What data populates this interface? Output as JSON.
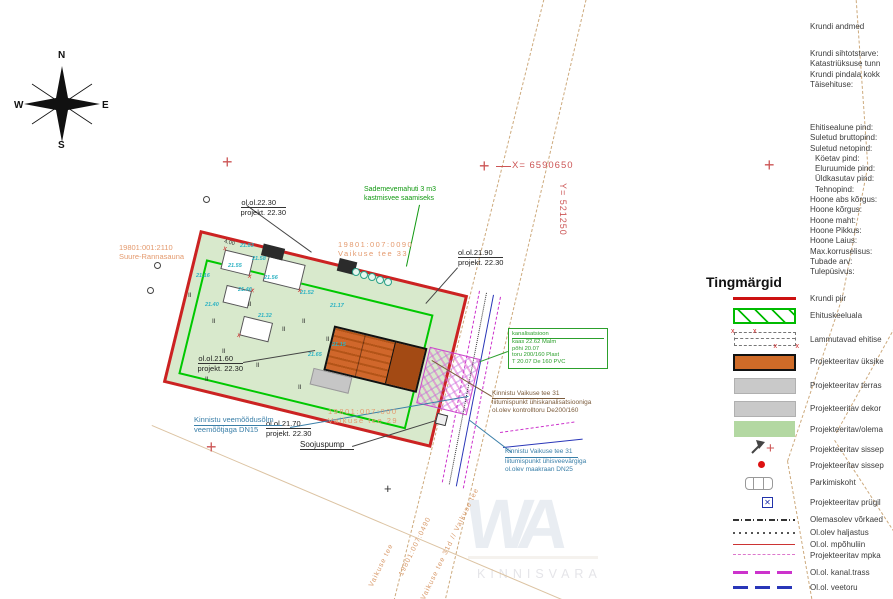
{
  "compass": {
    "n": "N",
    "e": "E",
    "s": "S",
    "w": "W"
  },
  "coords": {
    "x": "X= 6590650",
    "y": "Y= 521250"
  },
  "site_info": {
    "title": "Krundi andmed",
    "rows1": [
      "Krundi sihtotstarve:",
      "Katastriüksuse tunn",
      "Krundi pindala kokk",
      "Täisehituse:"
    ],
    "rows2": [
      "Ehitisealune pind:",
      "Suletud bruttopind:",
      "Suletud netopind:",
      "Köetav pind:",
      "Eluruumide pind:",
      "Üldkasutav pind:",
      "Tehnopind:",
      "Hoone abs kõrgus:",
      "Hoone kõrgus:",
      "Hoone maht:",
      "Hoone Pikkus:",
      "Hoone Laius:",
      "Max.korruselisus:",
      "Tubade arv:",
      "Tulepüsivus:"
    ]
  },
  "legend": {
    "title": "Tingmärgid",
    "items": [
      {
        "type": "red-line",
        "label": "Krundi piir"
      },
      {
        "type": "green-hatch",
        "label": "Ehituskeeluala"
      },
      {
        "type": "demolish",
        "label": "Lammutavad ehitise"
      },
      {
        "type": "orange-rect",
        "label": "Projekteeritav üksike"
      },
      {
        "type": "gray-rect",
        "label": "Projekteeritav terras"
      },
      {
        "type": "gray-rect",
        "label": "Projekteeritav dekor"
      },
      {
        "type": "green-rect",
        "label": "Projekteeritav/olema"
      },
      {
        "type": "entry-arrow",
        "label": "Projekteeritav sissep"
      },
      {
        "type": "red-dot",
        "label": "Projekteeritav sissep"
      },
      {
        "type": "car",
        "label": "Parkimiskoht"
      },
      {
        "type": "blue-box",
        "label": "Projekteeritav prügil"
      },
      {
        "type": "fence-line",
        "label": "Olemasolev võrkaed"
      },
      {
        "type": "dot-line",
        "label": "Ol.olev haljastus"
      },
      {
        "type": "red-thin",
        "label": "Ol.ol. mpõhuliin"
      },
      {
        "type": "pink-dash",
        "label": "Projekteeritav mpka"
      },
      {
        "type": "magenta-dash",
        "label": "Ol.ol. kanal.trass"
      },
      {
        "type": "blue-dash",
        "label": "Ol.ol. veetoru"
      }
    ]
  },
  "annotations": {
    "spot1": {
      "a": "ol.ol.22.30",
      "b": "projekt. 22.30"
    },
    "spot2": {
      "a": "ol.ol.21.90",
      "b": "projekt. 22.30"
    },
    "spot3": {
      "a": "ol.ol.21.60",
      "b": "projekt. 22.30"
    },
    "spot4": {
      "a": "ol.ol.21.70",
      "b": "projekt. 22.30"
    },
    "rain_tank": {
      "a": "Sademevemahuti 3 m3",
      "b": "kastmisvee saamiseks"
    },
    "parcel_nw": {
      "a": "19801:001:2110",
      "b": "Suure-Rannasauna"
    },
    "parcel_ne": {
      "a": "19801:007:0090",
      "b": "Vaikuse tee 33"
    },
    "parcel_s": {
      "a": "19801:007:000",
      "b": "Vaikuse tee 29"
    },
    "water_node": {
      "a": "Kinnistu veemõõdusõlm",
      "b": "veemõõtjaga DN15"
    },
    "heat_pump": "Soojuspump",
    "sewer_conn": {
      "a": "Kinnistu Vaikuse tee 31",
      "b": "liitumispunkt ühiskanalisatsiooniga",
      "c": "ol.olev kontrolltoru De200/160"
    },
    "water_conn": {
      "a": "Kinnistu Vaikuse tee 31",
      "b": "liitumispunkt ühisveevärgiga",
      "c": "ol.olev maakraan DN25"
    }
  },
  "manhole_box": {
    "l1": "kanalisatsioon",
    "l2": "kaas 22.62 Malm",
    "l3": "põhi 20.07",
    "l4": "toru 200/160 Plast",
    "l5": "T 20.07 De 160 PVC"
  },
  "road_labels": {
    "r1": "Vaikuse tee",
    "r2": "19801:007:0490",
    "r3": "Vaikuse tee 31d // Vaikuse tee"
  },
  "plan": {
    "elevations": [
      "21.83",
      "21.58",
      "21.55",
      "21.16",
      "21.56",
      "21.46",
      "21.40",
      "21.32",
      "21.17",
      "21.65",
      "21.15",
      "21.52"
    ],
    "tree_mark": "II",
    "dim": "4.00"
  },
  "watermark": {
    "logo": "WA",
    "text": "KINNISVARA"
  },
  "colors": {
    "boundary_red": "#cc2222",
    "keepout_green": "#00c800",
    "building_orange": "#d0672b",
    "parcel_green": "#d8e9cc",
    "road_tan": "#cdaa7d",
    "magenta": "#cc33cc",
    "utility_blue": "#2936b8"
  }
}
